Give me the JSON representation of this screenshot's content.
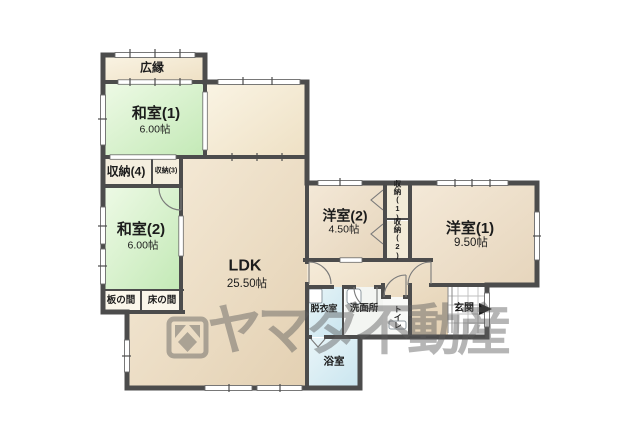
{
  "floorplan": {
    "rooms": {
      "hiroen": {
        "label": "広縁"
      },
      "washitsu1": {
        "label": "和室(1)",
        "area": "6.00帖"
      },
      "shuno4": {
        "label": "収納(4)"
      },
      "shuno3": {
        "label": "収納(3)"
      },
      "washitsu2": {
        "label": "和室(2)",
        "area": "6.00帖"
      },
      "itanoma": {
        "label": "板の間"
      },
      "tokonoma": {
        "label": "床の間"
      },
      "ldk": {
        "label": "LDK",
        "area": "25.50帖"
      },
      "yoshitsu2": {
        "label": "洋室(2)",
        "area": "4.50帖"
      },
      "shuno1": {
        "label": "収納(1)"
      },
      "shuno2": {
        "label": "収納(2)"
      },
      "yoshitsu1": {
        "label": "洋室(1)",
        "area": "9.50帖"
      },
      "datsuishitsu": {
        "label": "脱衣室"
      },
      "senmenjo": {
        "label": "洗面所"
      },
      "toire": {
        "label": "トイレ"
      },
      "genkan": {
        "label": "玄関"
      },
      "yokushitsu": {
        "label": "浴室"
      }
    },
    "watermark": {
      "text": "ヤマダ不動産"
    },
    "colors": {
      "wall": "#4c4c4c",
      "tatami_green": "#cdeec2",
      "cream": "#f6eedb",
      "ldk_tan": "#ecdfc8",
      "bath_blue": "#d7ebf2",
      "watermark_gray": "#5c5c5c"
    }
  }
}
